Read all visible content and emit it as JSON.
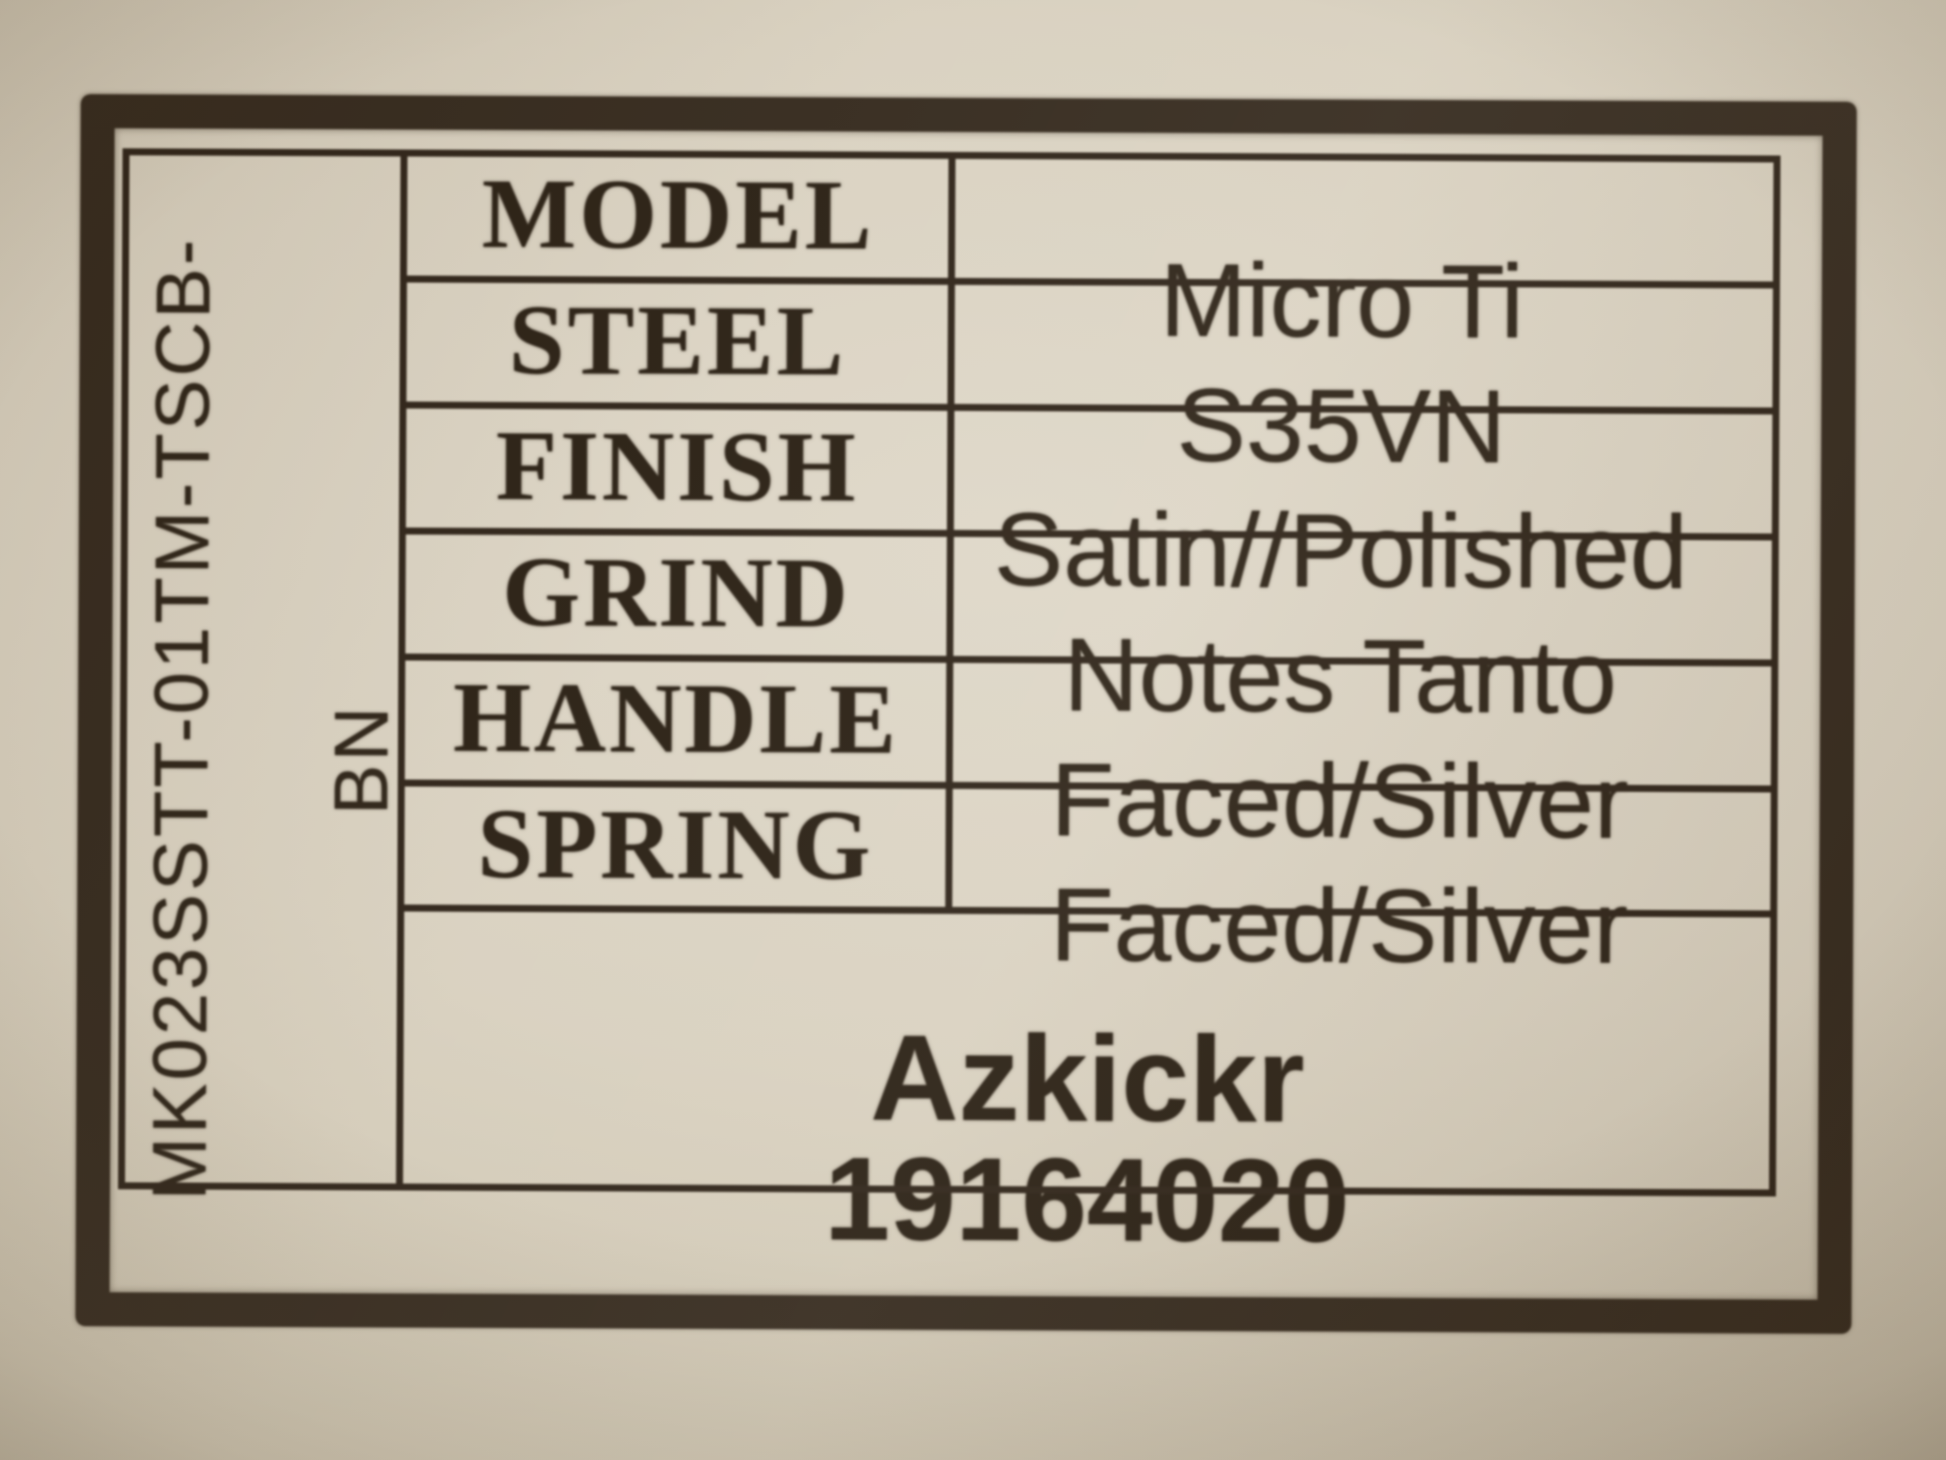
{
  "side_code": {
    "part_number": "MK023SSTT-01TM-TSCB-",
    "suffix": "BN"
  },
  "table": {
    "row_labels": [
      "MODEL",
      "STEEL",
      "FINISH",
      "GRIND",
      "HANDLE",
      "SPRING"
    ],
    "value_lines": [
      "Micro Ti",
      "S35VN",
      "Satin//Polished",
      "Notes Tanto",
      "Faced/Silver",
      "Faced/Silver"
    ]
  },
  "footer": {
    "product_name": "Azkickr",
    "serial_number": "19164020"
  },
  "palette": {
    "paper": "#d8d0bf",
    "ink": "#2b2015",
    "frame_border": "#31261a"
  }
}
